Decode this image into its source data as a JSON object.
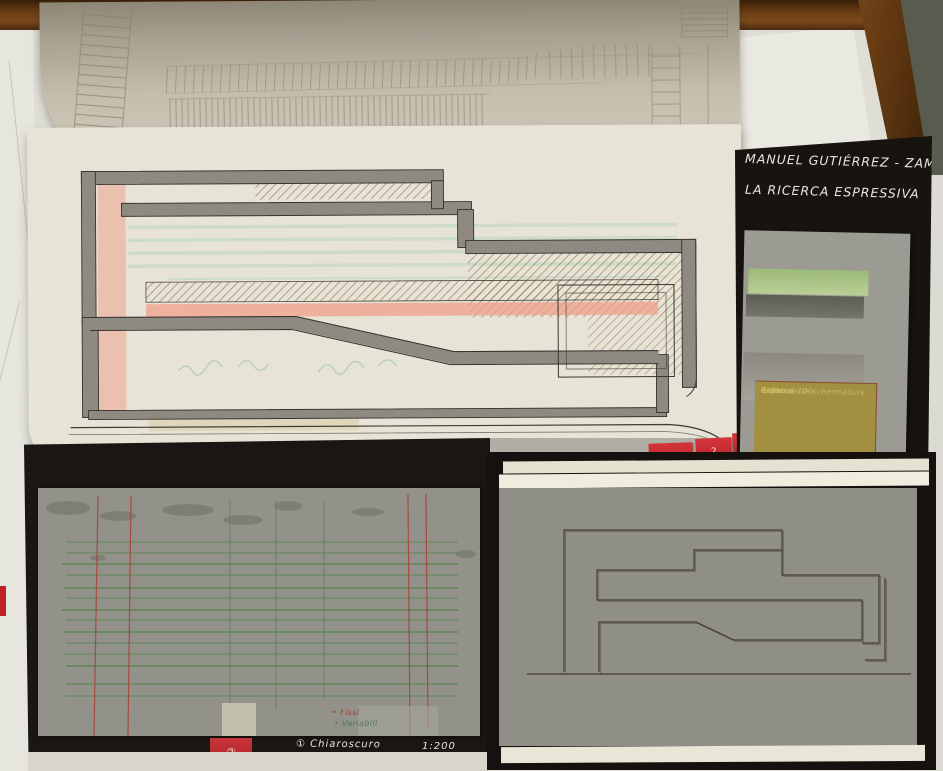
{
  "title_board": {
    "line1": "MANUEL GUTIÉRREZ - ZAMORA J.",
    "line2": "LA RICERCA ESPRESSIVA"
  },
  "page_tabs": {
    "tab3": "3",
    "tab2": "2",
    "tab1": "1"
  },
  "grid_board": {
    "legend_fixed": "• Fissi",
    "legend_variable": "• Variabili",
    "caption1": "① Chiaroscuro",
    "caption2": "② Grilla",
    "scale": "1:200",
    "tab": "②"
  },
  "notes_panel": {
    "line1": "Grilla al 100",
    "line2": "Colore",
    "line3": "aspetto",
    "line4": "Ritmo delle schermature"
  },
  "colors": {
    "tab_red": "#c02127",
    "board_black": "#171310",
    "wood_brown": "#6b3d14",
    "floor_green_gray": "#585c4e",
    "tracing_paper": "#e7e3d7",
    "gray_sheet": "#92928b",
    "olive_notes": "#a28f3f",
    "green_band": "#9cba78",
    "salmon_marker": "#efa08b",
    "tan_hatch": "#8a6b42",
    "grid_green": "#57834f",
    "grid_red": "#a8453a"
  }
}
